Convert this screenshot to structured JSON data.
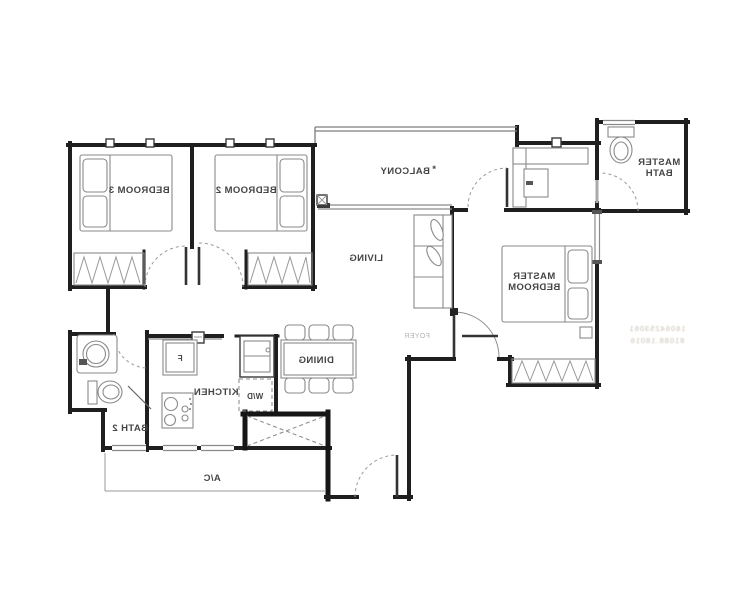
{
  "page": {
    "background": "#ffffff",
    "description": "mirrored apartment floor plan"
  },
  "colors": {
    "wall": "#1f1f1f",
    "furniture": "#8a8a8a",
    "label": "#454545",
    "faint_label": "#b3b3b3",
    "watermark": "#c2b9ac"
  },
  "labels": {
    "bedroom3": "BEDROOM 3",
    "bedroom2": "BEDROOM 2",
    "balcony": "BALCONY",
    "balcony_note": "*",
    "living": "LIVING",
    "master_bedroom_1": "MASTER",
    "master_bedroom_2": "BEDROOM",
    "master_bath_1": "MASTER",
    "master_bath_2": "BATH",
    "bath2": "BATH 2",
    "kitchen": "KITCHEN",
    "dining": "DINING",
    "foyer": "FOYER",
    "ac_ledge": "A/C",
    "fridge": "F",
    "washer_dryer": "W/D"
  },
  "watermark": {
    "line1": "16064253061",
    "line2": "81088.18016"
  }
}
